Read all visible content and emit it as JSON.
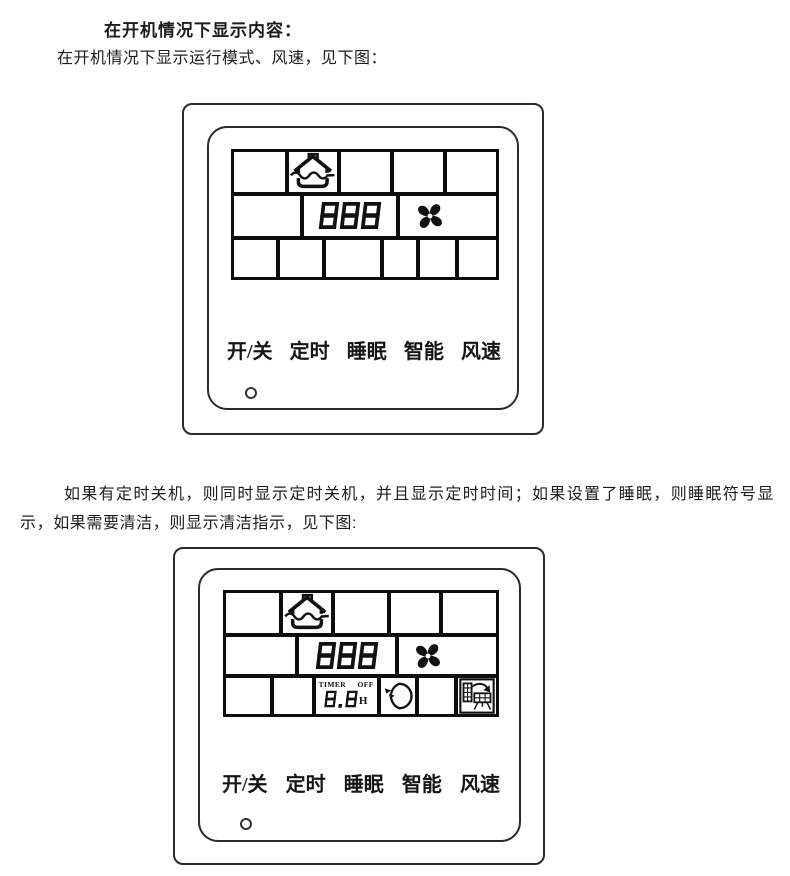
{
  "texts": {
    "heading": "在开机情况下显示内容：",
    "intro": "在开机情况下显示运行模式、风速，见下图：",
    "body": "如果有定时关机，则同时显示定时关机，并且显示定时时间；如果设置了睡眠，则睡眠符号显示，如果需要清洁，则显示清洁指示，见下图:"
  },
  "panel_on": {
    "display": {
      "temperature": "888"
    },
    "buttons": [
      "开/关",
      "定时",
      "睡眠",
      "智能",
      "风速"
    ]
  },
  "panel_timer": {
    "display": {
      "temperature": "888",
      "timer_label": "TIMER",
      "timer_state": "OFF",
      "timer_hours": "8.8",
      "timer_unit": "H"
    },
    "buttons": [
      "开/关",
      "定时",
      "睡眠",
      "智能",
      "风速"
    ]
  },
  "icons": {
    "mode": "house-ventilation-mode-icon",
    "fan": "fan-speed-icon",
    "sleep": "sleep-moon-icon",
    "clean": "clean-filter-icon",
    "led": "power-indicator-led"
  },
  "colors": {
    "ink": "#111111",
    "panel_border": "#2a2a2a",
    "background": "#ffffff"
  }
}
